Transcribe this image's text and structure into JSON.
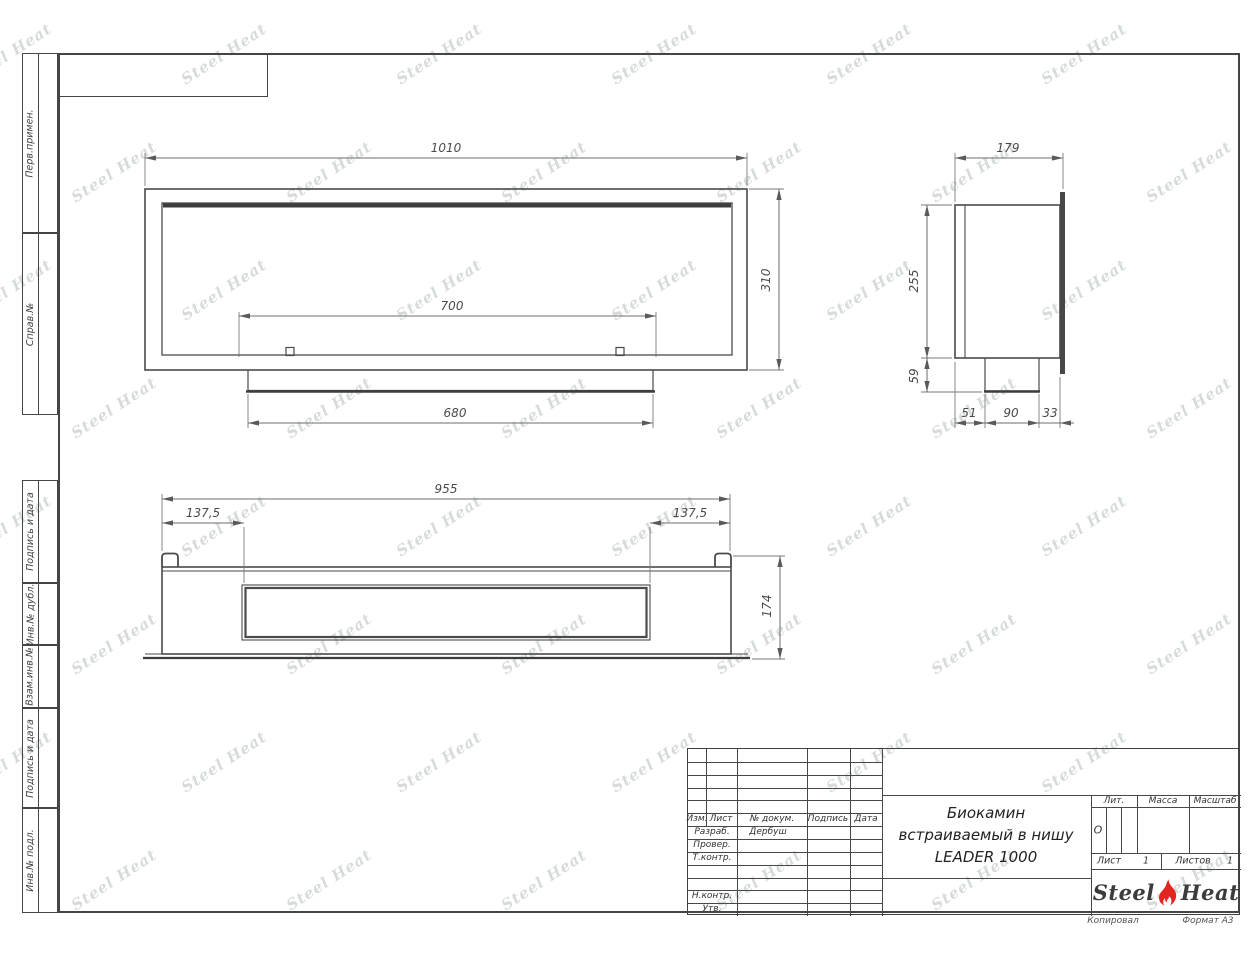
{
  "watermark": {
    "text": "Steel Heat"
  },
  "frame": {
    "labels": [
      {
        "text": "Перв.примен."
      },
      {
        "text": "Справ.№"
      },
      {
        "text": "Подпись и дата"
      },
      {
        "text": "Инв.№ дубл."
      },
      {
        "text": "Взам.инв.№"
      },
      {
        "text": "Подпись и дата"
      },
      {
        "text": "Инв.№ подл."
      }
    ]
  },
  "views": {
    "front": {
      "dim_width": "1010",
      "dim_height": "310",
      "dim_opening": "700",
      "dim_tray": "680"
    },
    "side": {
      "dim_depth": "179",
      "dim_body_height": "255",
      "dim_tray_height": "59",
      "dim_back_offset": "51",
      "dim_tray_width": "90",
      "dim_front_offset": "33"
    },
    "bottom": {
      "dim_width": "955",
      "dim_offset_left": "137,5",
      "dim_offset_right": "137,5",
      "dim_depth": "174"
    }
  },
  "title_block": {
    "revision_header": {
      "izm": "Изм.",
      "list": "Лист",
      "doc": "№ докум.",
      "sign": "Подпись",
      "date": "Дата"
    },
    "rows": {
      "razrab": {
        "label": "Разраб.",
        "value": "Дербуш"
      },
      "prover": {
        "label": "Провер."
      },
      "tkontr": {
        "label": "Т.контр."
      },
      "nkontr": {
        "label": "Н.контр."
      },
      "utv": {
        "label": "Утв."
      }
    },
    "title_lines": [
      "Биокамин",
      "встраиваемый в нишу",
      "LEADER 1000"
    ],
    "lit_header": "Лит.",
    "massa_header": "Масса",
    "masshtab_header": "Масштаб",
    "lit_value": "О",
    "sheet_label": "Лист",
    "sheet_value": "1",
    "sheets_label": "Листов",
    "sheets_value": "1",
    "logo": {
      "part1": "Steel",
      "part2": "Heat"
    },
    "below": {
      "left": "Копировал",
      "right": "Формат А3"
    }
  }
}
